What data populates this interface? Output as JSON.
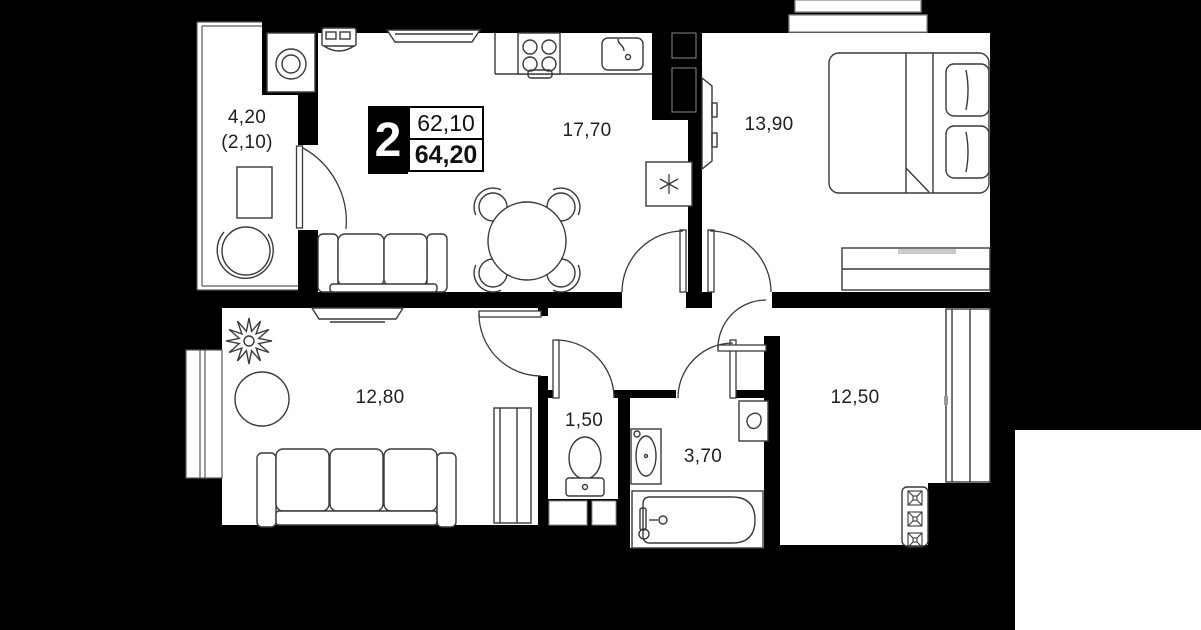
{
  "badge": {
    "rooms_count": "2",
    "area_top": "62,10",
    "area_bottom": "64,20"
  },
  "rooms": [
    {
      "id": "balcony",
      "area": "4,20",
      "area_secondary": "(2,10)"
    },
    {
      "id": "kitchen-living",
      "area": "17,70"
    },
    {
      "id": "bedroom",
      "area": "13,90"
    },
    {
      "id": "living-room",
      "area": "12,80"
    },
    {
      "id": "wc",
      "area": "1,50"
    },
    {
      "id": "bathroom",
      "area": "3,70"
    },
    {
      "id": "hall-room",
      "area": "12,50"
    }
  ],
  "colors": {
    "background": "#000000",
    "floor": "#ffffff",
    "walls": "#000000",
    "furniture_line": "#3a3a3a",
    "label_text": "#1f1f1f"
  }
}
